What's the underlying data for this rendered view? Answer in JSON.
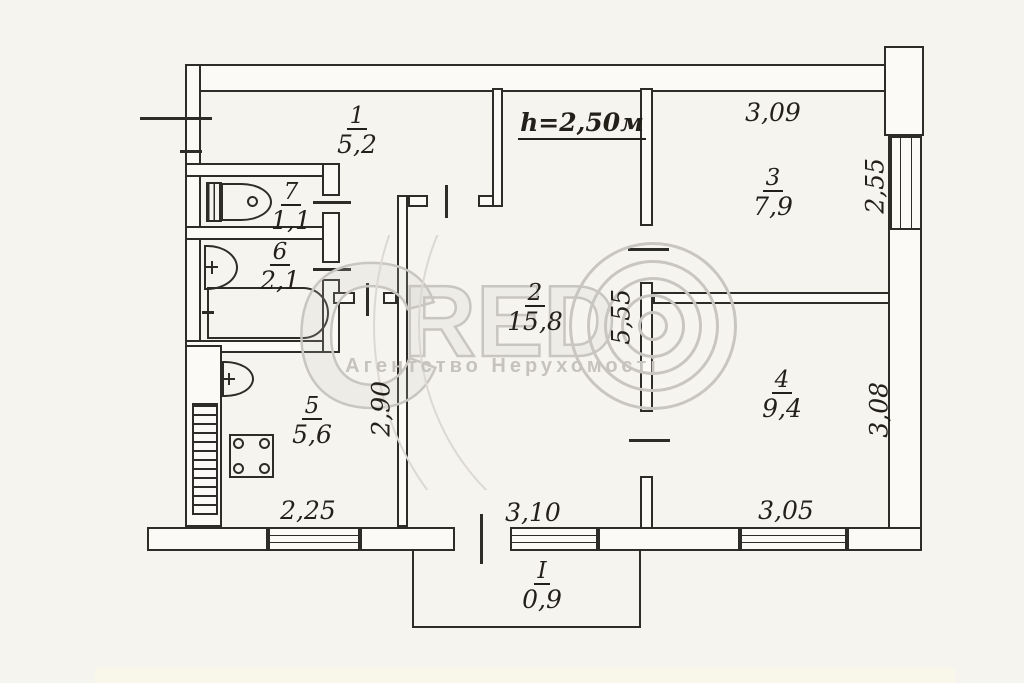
{
  "watermark": {
    "letter_c": "C",
    "letters_red": "RED",
    "subtitle": "Агентство Нерухомості"
  },
  "labels": {
    "ceiling_height": "h=2,50м"
  },
  "rooms": [
    {
      "number": "1",
      "area": "5,2"
    },
    {
      "number": "2",
      "area": "15,8"
    },
    {
      "number": "3",
      "area": "7,9"
    },
    {
      "number": "4",
      "area": "9,4"
    },
    {
      "number": "5",
      "area": "5,6"
    },
    {
      "number": "6",
      "area": "2,1"
    },
    {
      "number": "7",
      "area": "1,1"
    }
  ],
  "balcony": {
    "number": "I",
    "area": "0,9"
  },
  "dimensions": {
    "room3_top": "3,09",
    "room3_right_window": "2,55",
    "room2_height": "5,55",
    "kitchen_height": "2,90",
    "kitchen_window": "2,25",
    "room2_window": "3,10",
    "room4_window": "3,05",
    "room4_right": "3,08"
  },
  "colors": {
    "ink": "#2e2c29",
    "paper": "#f6f4ef",
    "watermark": "#c9c6c1"
  }
}
